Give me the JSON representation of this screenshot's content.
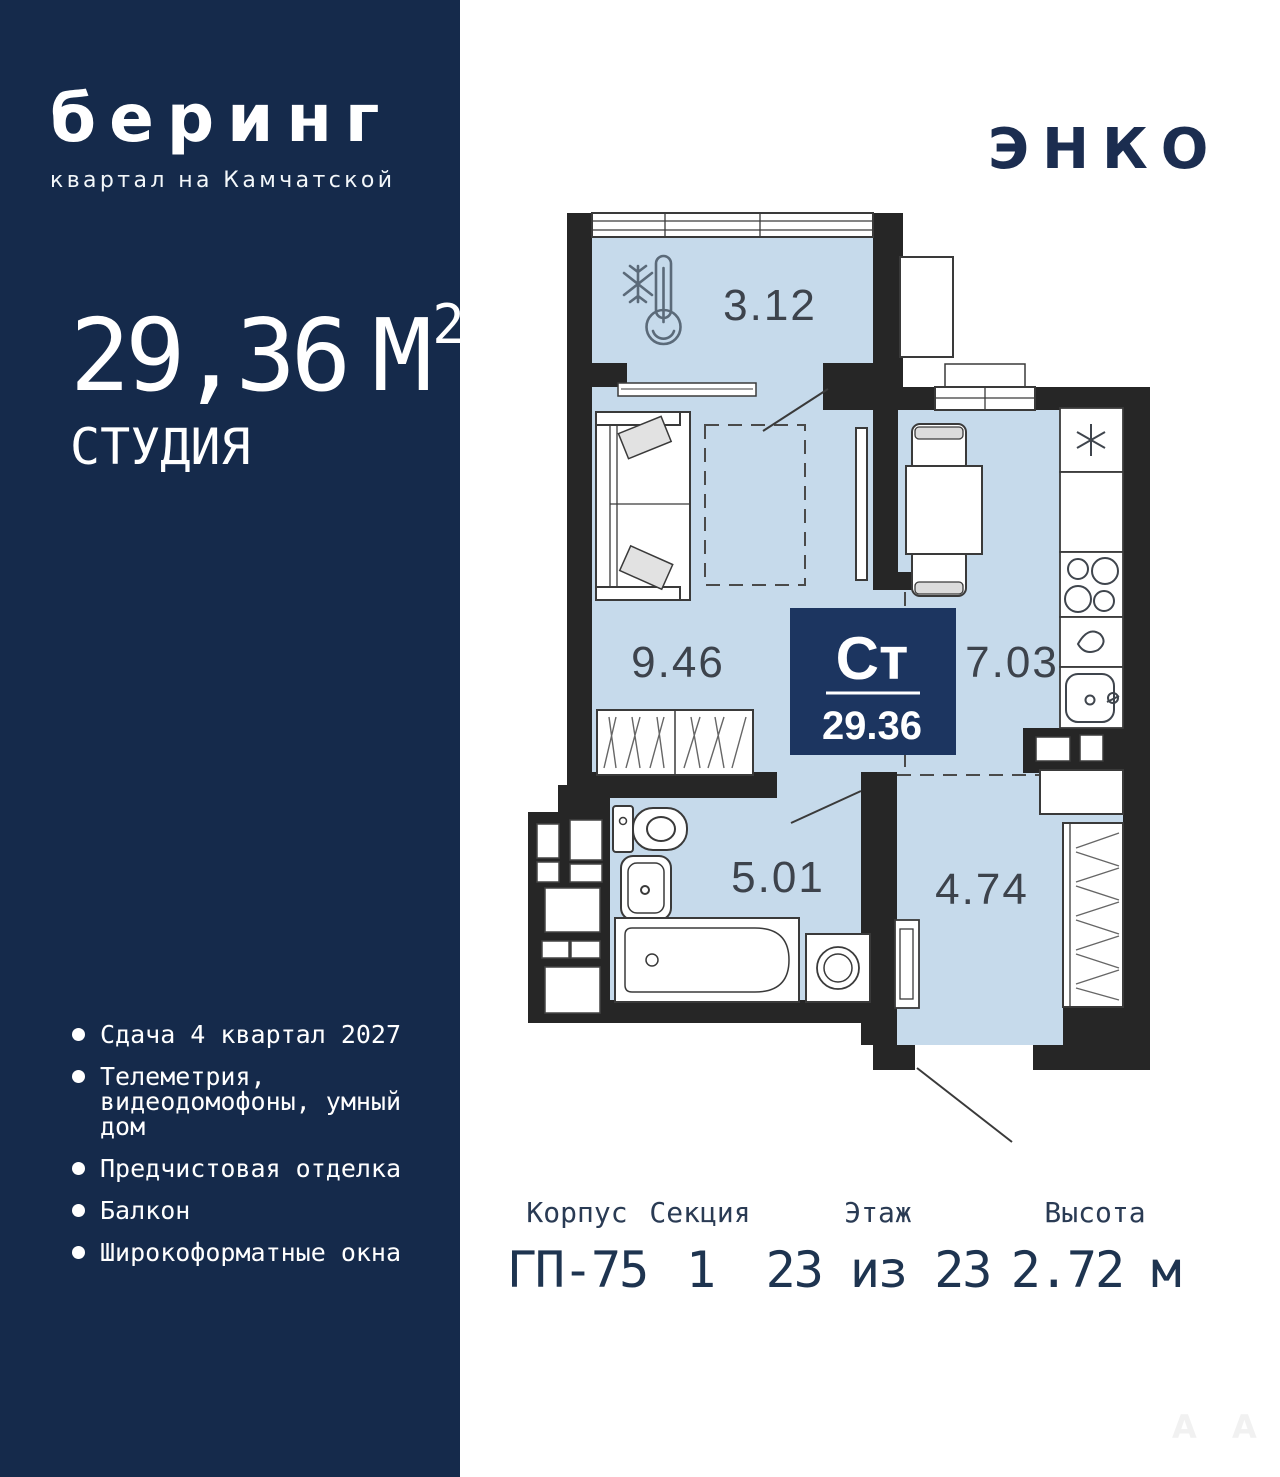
{
  "sidebar": {
    "logo_title": "беринг",
    "logo_subtitle": "квартал на Камчатской",
    "area_value": "29,36",
    "area_unit": "М",
    "area_sup": "2",
    "type_label": "СТУДИЯ",
    "features": [
      "Сдача 4 квартал 2027",
      "Телеметрия, видеодомофоны, умный дом",
      "Предчистовая отделка",
      "Балкон",
      "Широкоформатные окна"
    ]
  },
  "header": {
    "developer_logo": "ЭНКО"
  },
  "plan": {
    "rooms": [
      {
        "id": "balcony",
        "area": "3.12"
      },
      {
        "id": "living",
        "area": "9.46"
      },
      {
        "id": "kitchen",
        "area": "7.03"
      },
      {
        "id": "bathroom",
        "area": "5.01"
      },
      {
        "id": "hall",
        "area": "4.74"
      }
    ],
    "badge": {
      "type": "Ст",
      "area": "29.36"
    }
  },
  "info": {
    "columns": [
      {
        "label": "Корпус",
        "value": "ГП-75"
      },
      {
        "label": "Секция",
        "value": "1"
      },
      {
        "label": "Этаж",
        "value": "23 из 23"
      },
      {
        "label": "Высота",
        "value": "2.72 м"
      }
    ]
  },
  "watermark": {
    "letters": [
      "А",
      "А"
    ]
  },
  "colors": {
    "sidebar_bg": "#152a4b",
    "badge_bg": "#1c3560",
    "room_fill": "#c6daeb",
    "wall": "#262626",
    "info_text": "#1e3450",
    "enko_logo": "#1b2d50"
  }
}
